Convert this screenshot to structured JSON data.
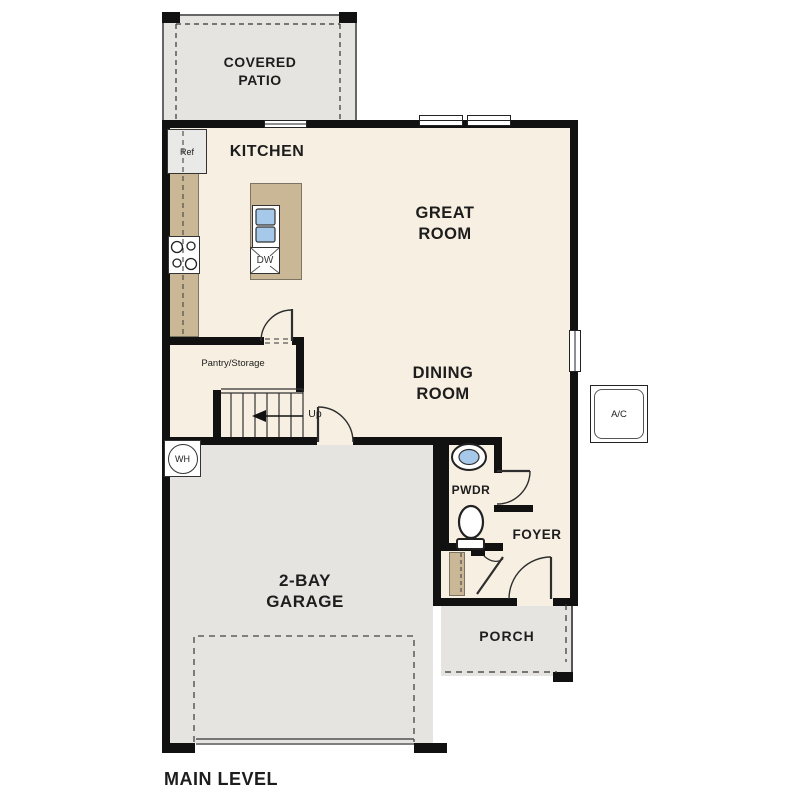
{
  "plan": {
    "title": "MAIN LEVEL",
    "rooms": {
      "covered_patio": "COVERED PATIO",
      "kitchen": "KITCHEN",
      "great_room": "GREAT ROOM",
      "dining_room": "DINING ROOM",
      "pantry": "Pantry/Storage",
      "powder_room": "PWDR",
      "foyer": "FOYER",
      "garage": "2-BAY GARAGE",
      "porch": "PORCH"
    },
    "fixtures": {
      "refrigerator": "Ref",
      "dishwasher": "DW",
      "water_heater": "WH",
      "air_conditioner": "A/C",
      "stairs_direction": "Up"
    },
    "colors": {
      "floor": "#f7efe2",
      "exterior_surface": "#e5e4e1",
      "casework": "#c9b795",
      "sink": "#a6c8e9",
      "wall": "#111111",
      "text": "#1d1d1d"
    }
  }
}
